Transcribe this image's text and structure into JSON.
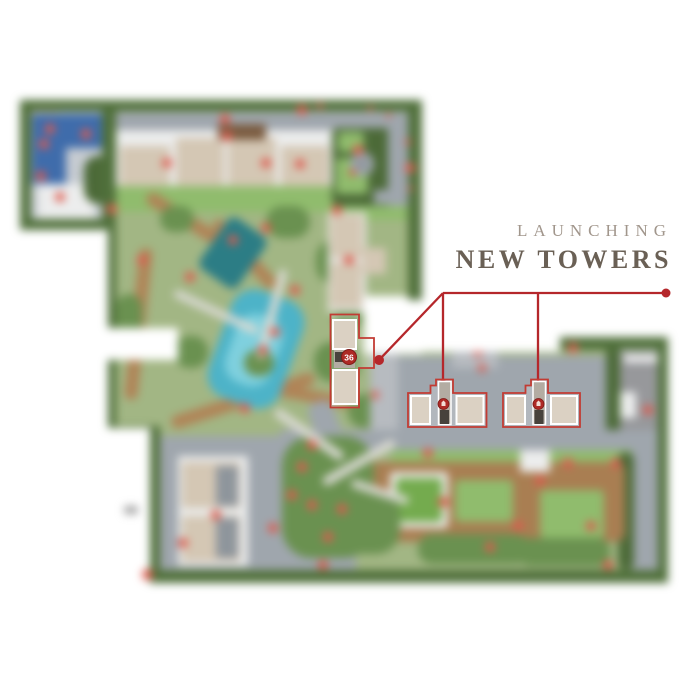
{
  "title": {
    "eyebrow": "LAUNCHING",
    "main": "NEW TOWERS"
  },
  "badges": {
    "tower36": "36"
  },
  "colors": {
    "red": "#b5272b",
    "highlight": "#c23b33",
    "marker": "#de5a4e",
    "badge_bg": "#ae2a26",
    "badge_ring": "#7e1b18",
    "title_eyebrow": "#a1968c",
    "title_main": "#6a6055",
    "hedge": "#50703b",
    "treeDark": "#4c6a38",
    "treeMid": "#6a9150",
    "lawn": "#a2b684",
    "lawnBright": "#90bc6d",
    "courtGreen": "#74ab4e",
    "road": "#9fa6ad",
    "road2": "#b7bbc0",
    "paving": "#c6cbd1",
    "path": "#d9d9d2",
    "white": "#ffffff",
    "white2": "#eceded",
    "beige": "#d4c7b4",
    "brown": "#7b5c41",
    "deck": "#b08457",
    "deck2": "#a97e52",
    "poolDark": "#2c7d85",
    "poolLight": "#4db3c8",
    "poolCore": "#7fd0de",
    "courtBlue": "#3f6cab",
    "concrete": "#97989b",
    "gray3": "#8e959c",
    "blob": "#8f8f8f",
    "cell": "#dbd1c3",
    "colFill": "#b3aca2",
    "colDark": "#47423c"
  },
  "map": {
    "shapes": [
      [
        0,
        0,
        655,
        483,
        "lawn"
      ],
      [
        2,
        8,
        88,
        118,
        "paving"
      ],
      [
        6,
        8,
        34,
        28,
        "beige"
      ],
      [
        12,
        14,
        74,
        70,
        "courtBlue"
      ],
      [
        46,
        48,
        38,
        36,
        "paving"
      ],
      [
        18,
        84,
        56,
        40,
        "white2"
      ],
      [
        64,
        56,
        30,
        48,
        "treeDark",
        14
      ],
      [
        86,
        12,
        310,
        18,
        "road"
      ],
      [
        96,
        30,
        235,
        70,
        "white2"
      ],
      [
        100,
        46,
        50,
        50,
        "beige"
      ],
      [
        156,
        38,
        48,
        58,
        "beige"
      ],
      [
        208,
        38,
        48,
        58,
        "beige"
      ],
      [
        261,
        46,
        48,
        50,
        "beige"
      ],
      [
        198,
        24,
        48,
        16,
        "brown"
      ],
      [
        86,
        86,
        316,
        26,
        "lawnBright"
      ],
      [
        312,
        28,
        78,
        78,
        "treeDark",
        6
      ],
      [
        316,
        58,
        32,
        36,
        "lawnBright",
        4
      ],
      [
        318,
        32,
        26,
        20,
        "lawnBright",
        4
      ],
      [
        368,
        22,
        24,
        88,
        "road"
      ],
      [
        330,
        52,
        24,
        24,
        "road",
        12
      ],
      [
        336,
        58,
        12,
        12,
        "gray3",
        6
      ],
      [
        354,
        90,
        40,
        14,
        "road"
      ],
      [
        312,
        106,
        80,
        14,
        "lawnBright"
      ],
      [
        120,
        116,
        100,
        13,
        "deck",
        6,
        32
      ],
      [
        112,
        148,
        13,
        152,
        "deck",
        6,
        6
      ],
      [
        148,
        294,
        150,
        13,
        "deck",
        6,
        -18
      ],
      [
        218,
        110,
        13,
        88,
        "deck",
        6,
        -42
      ],
      [
        256,
        292,
        92,
        12,
        "deck",
        6,
        10
      ],
      [
        190,
        122,
        46,
        62,
        "poolDark",
        8,
        35
      ],
      [
        198,
        192,
        76,
        114,
        "poolLight",
        24,
        20
      ],
      [
        210,
        214,
        48,
        72,
        "poolCore",
        20,
        20
      ],
      [
        140,
        106,
        34,
        26,
        "treeMid",
        13
      ],
      [
        246,
        106,
        44,
        32,
        "treeMid",
        16
      ],
      [
        296,
        140,
        42,
        44,
        "treeMid",
        18
      ],
      [
        154,
        236,
        34,
        32,
        "treeMid",
        15
      ],
      [
        294,
        242,
        46,
        40,
        "treeMid",
        18
      ],
      [
        328,
        294,
        42,
        34,
        "treeMid",
        16
      ],
      [
        96,
        194,
        26,
        46,
        "treeMid",
        13
      ],
      [
        224,
        250,
        30,
        26,
        "treeMid",
        13
      ],
      [
        314,
        204,
        28,
        26,
        "treeMid",
        13
      ],
      [
        150,
        208,
        92,
        8,
        "path",
        4,
        25
      ],
      [
        248,
        168,
        8,
        92,
        "path",
        4,
        15
      ],
      [
        308,
        112,
        38,
        100,
        "white2"
      ],
      [
        310,
        114,
        33,
        44,
        "beige"
      ],
      [
        310,
        162,
        32,
        46,
        "beige"
      ],
      [
        343,
        148,
        23,
        26,
        "beige"
      ],
      [
        344,
        196,
        58,
        58,
        "white"
      ],
      [
        295,
        300,
        26,
        62,
        "road",
        10,
        -20
      ],
      [
        372,
        256,
        226,
        86,
        "road"
      ],
      [
        432,
        242,
        46,
        26,
        "road2"
      ],
      [
        350,
        254,
        28,
        78,
        "road2"
      ],
      [
        596,
        248,
        56,
        104,
        "white2"
      ],
      [
        600,
        252,
        48,
        96,
        "concrete"
      ],
      [
        600,
        292,
        16,
        26,
        "white2"
      ],
      [
        604,
        256,
        40,
        6,
        "white"
      ],
      [
        586,
        238,
        14,
        114,
        "treeDark",
        7
      ],
      [
        138,
        336,
        198,
        134,
        "road"
      ],
      [
        260,
        330,
        380,
        22,
        "road"
      ],
      [
        372,
        350,
        240,
        22,
        "lawnBright"
      ],
      [
        612,
        344,
        30,
        128,
        "road"
      ],
      [
        598,
        352,
        16,
        118,
        "treeDark",
        8
      ],
      [
        343,
        362,
        262,
        80,
        "deck2",
        10
      ],
      [
        370,
        372,
        58,
        56,
        "white2",
        4
      ],
      [
        376,
        378,
        46,
        44,
        "courtGreen",
        3
      ],
      [
        355,
        405,
        18,
        18,
        "white2"
      ],
      [
        435,
        380,
        58,
        42,
        "lawnBright",
        4
      ],
      [
        520,
        390,
        64,
        48,
        "lawnBright",
        4
      ],
      [
        500,
        350,
        30,
        22,
        "white2"
      ],
      [
        262,
        336,
        92,
        122,
        "treeMid",
        30
      ],
      [
        292,
        390,
        88,
        64,
        "treeMid",
        24
      ],
      [
        398,
        434,
        112,
        30,
        "treeMid",
        14
      ],
      [
        498,
        438,
        92,
        28,
        "treeMid",
        12
      ],
      [
        158,
        356,
        70,
        110,
        "white2"
      ],
      [
        162,
        362,
        58,
        46,
        "beige"
      ],
      [
        162,
        416,
        58,
        46,
        "beige"
      ],
      [
        196,
        366,
        22,
        40,
        "gray3"
      ],
      [
        196,
        418,
        22,
        40,
        "gray3"
      ],
      [
        248,
        330,
        82,
        9,
        "path",
        4,
        35
      ],
      [
        298,
        358,
        82,
        9,
        "path",
        4,
        -30
      ],
      [
        330,
        388,
        60,
        8,
        "path",
        4,
        18
      ],
      [
        0,
        0,
        404,
        11,
        "hedge"
      ],
      [
        0,
        0,
        11,
        132,
        "hedge"
      ],
      [
        0,
        119,
        92,
        12,
        "hedge"
      ],
      [
        82,
        8,
        14,
        124,
        "hedge"
      ],
      [
        84,
        120,
        12,
        212,
        "hedge"
      ],
      [
        84,
        326,
        48,
        12,
        "hedge"
      ],
      [
        128,
        326,
        12,
        152,
        "hedge"
      ],
      [
        128,
        470,
        528,
        13,
        "hedge"
      ],
      [
        638,
        237,
        16,
        246,
        "hedge"
      ],
      [
        538,
        237,
        104,
        13,
        "hedge"
      ],
      [
        388,
        0,
        14,
        200,
        "hedge"
      ],
      [
        84,
        228,
        74,
        32,
        "white"
      ]
    ],
    "markers": [
      [
        282,
        10
      ],
      [
        205,
        19
      ],
      [
        207,
        36
      ],
      [
        147,
        63
      ],
      [
        246,
        63
      ],
      [
        280,
        64
      ],
      [
        30,
        29
      ],
      [
        66,
        34
      ],
      [
        24,
        44
      ],
      [
        21,
        76
      ],
      [
        40,
        97
      ],
      [
        92,
        109
      ],
      [
        317,
        110
      ],
      [
        390,
        68
      ],
      [
        338,
        50
      ],
      [
        332,
        72,
        7
      ],
      [
        170,
        177
      ],
      [
        213,
        140
      ],
      [
        246,
        128
      ],
      [
        275,
        190
      ],
      [
        255,
        232
      ],
      [
        243,
        250
      ],
      [
        225,
        308
      ],
      [
        329,
        160
      ],
      [
        122,
        160
      ],
      [
        355,
        295,
        8
      ],
      [
        458,
        252
      ],
      [
        462,
        268,
        8
      ],
      [
        553,
        248
      ],
      [
        628,
        310
      ],
      [
        292,
        345
      ],
      [
        282,
        367
      ],
      [
        272,
        395
      ],
      [
        292,
        405
      ],
      [
        322,
        409
      ],
      [
        308,
        437
      ],
      [
        253,
        428
      ],
      [
        196,
        415
      ],
      [
        163,
        443
      ],
      [
        303,
        465
      ],
      [
        408,
        353
      ],
      [
        423,
        402
      ],
      [
        470,
        447
      ],
      [
        498,
        426
      ],
      [
        520,
        381
      ],
      [
        548,
        363
      ],
      [
        596,
        363
      ],
      [
        588,
        465
      ],
      [
        571,
        426
      ],
      [
        350,
        8,
        5
      ],
      [
        368,
        15,
        5
      ],
      [
        388,
        42,
        6
      ],
      [
        390,
        88,
        5
      ],
      [
        300,
        6,
        6
      ]
    ]
  }
}
